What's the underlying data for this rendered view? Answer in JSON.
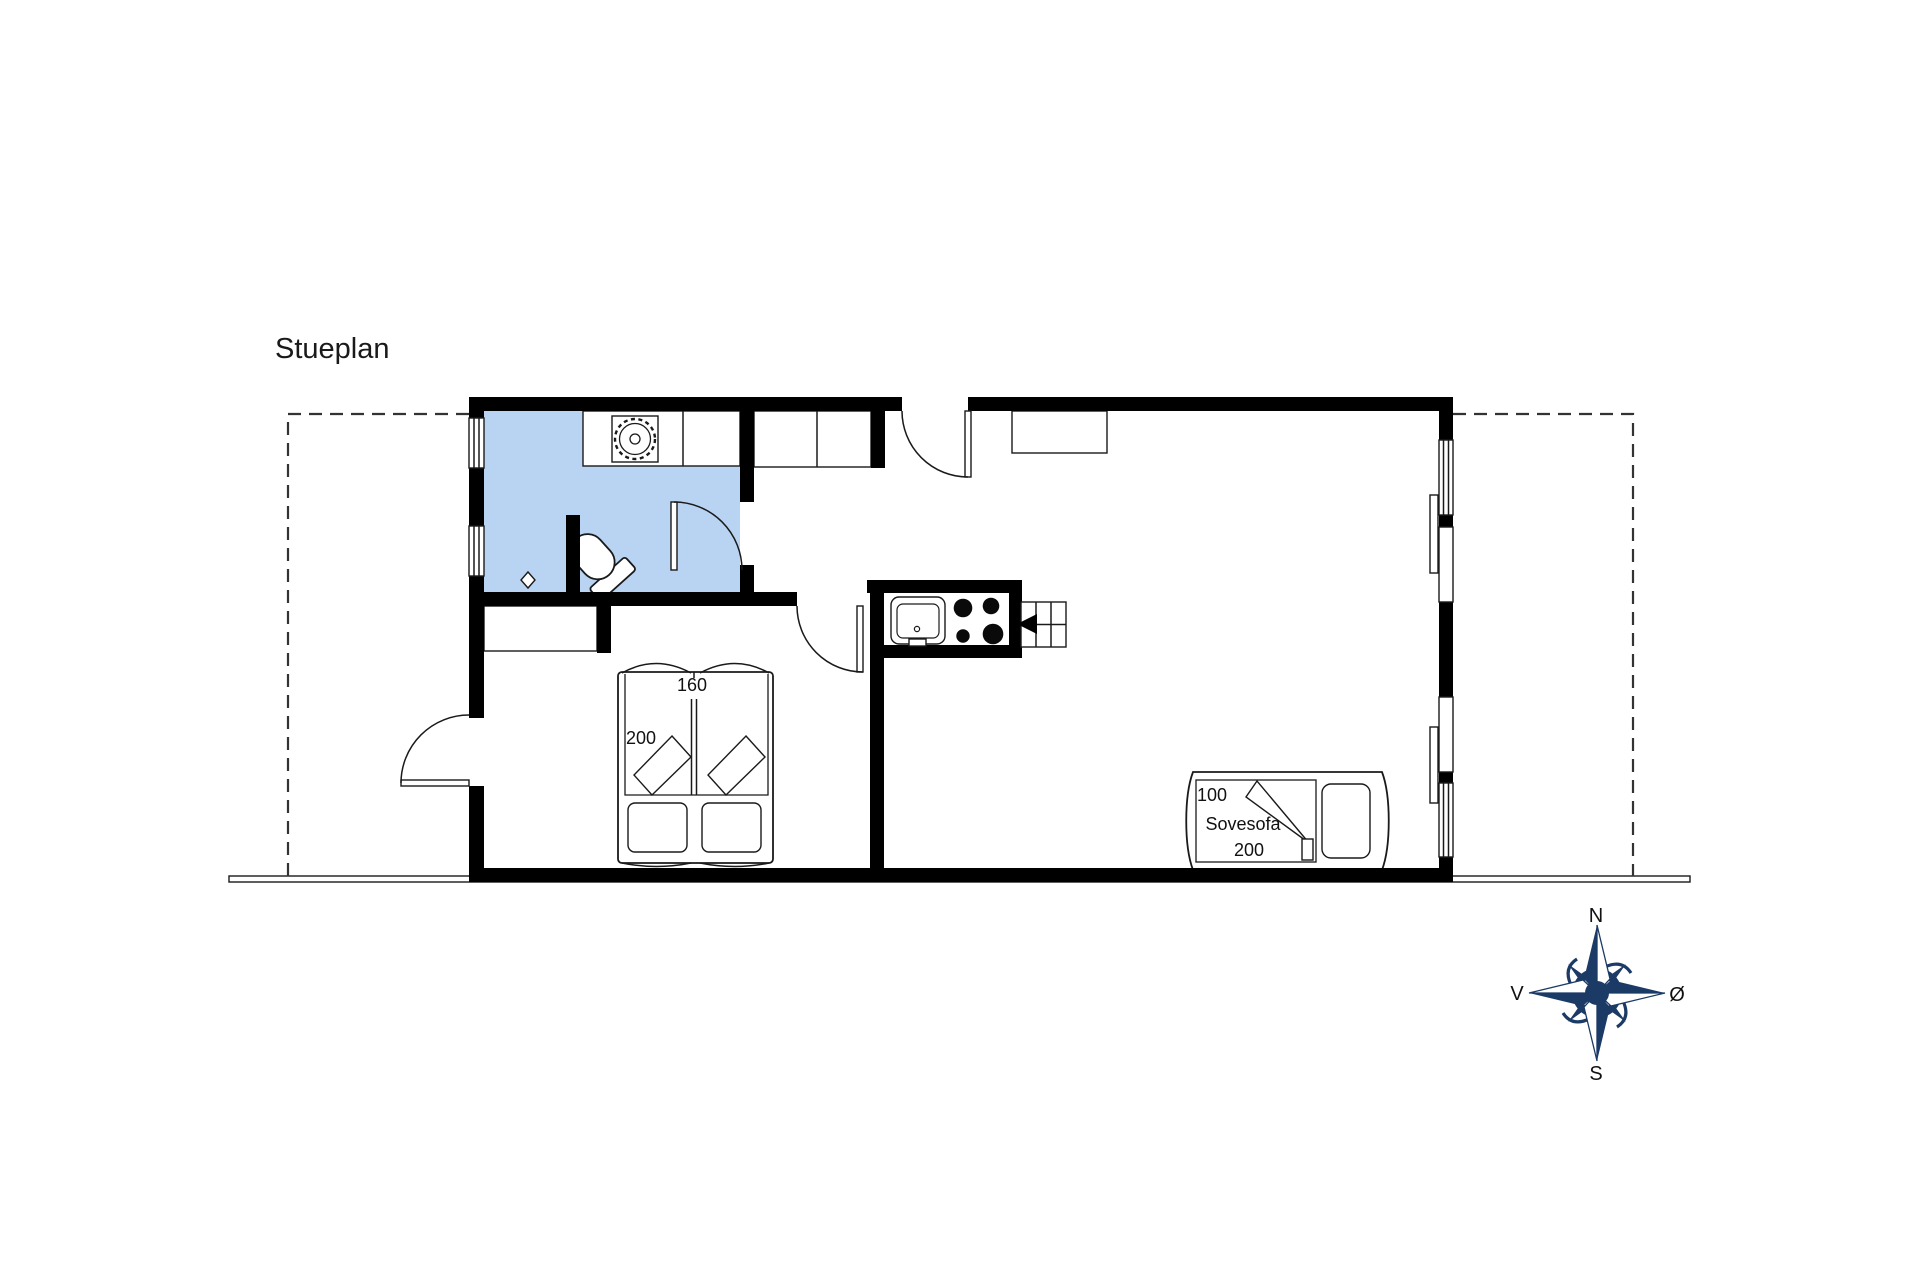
{
  "title": "Stueplan",
  "plan": {
    "bed": {
      "width_label": "160",
      "length_label": "200"
    },
    "sofa": {
      "width_label": "100",
      "name_label": "Sovesofa",
      "length_label": "200"
    }
  },
  "compass": {
    "north": "N",
    "south": "S",
    "west": "V",
    "east": "Ø"
  },
  "colors": {
    "bathroom_fill": "#b9d4f2",
    "compass_navy": "#1b3a66",
    "wall": "#000000"
  }
}
